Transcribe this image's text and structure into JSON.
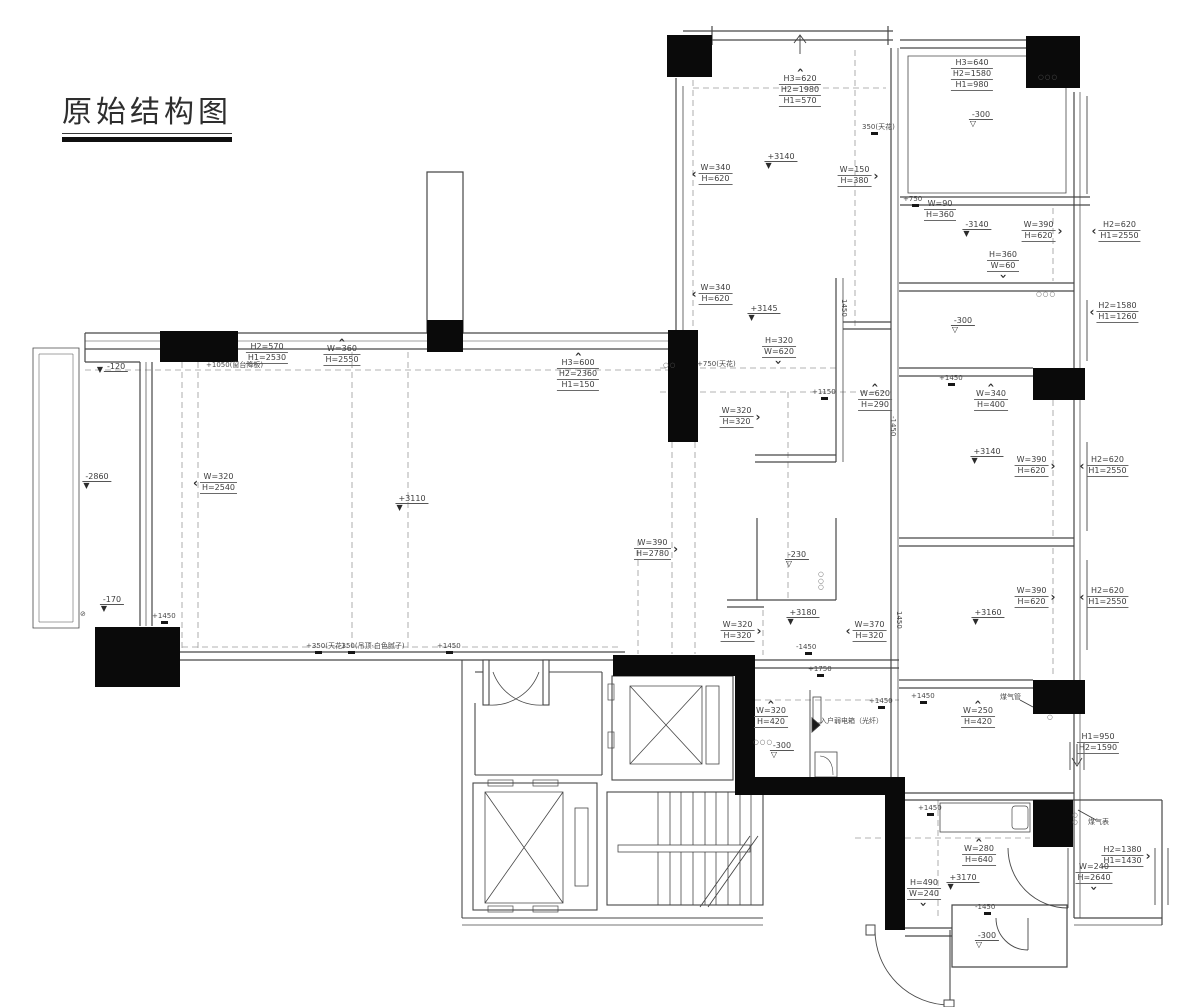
{
  "title": {
    "text": "原始结构图"
  },
  "colors": {
    "ink": "#3d3d3d",
    "wall": "#474747",
    "column": "#0a0a0a",
    "dashed": "#9a9a9a",
    "background": "#ffffff"
  },
  "annotations": [
    {
      "type": "dim",
      "x": 800,
      "y": 66,
      "lines": [
        "H3=620",
        "H2=1980",
        "H1=570"
      ],
      "arrow": "up"
    },
    {
      "type": "dim",
      "x": 712,
      "y": 163,
      "lines": [
        "W=340",
        "H=620"
      ],
      "arrow": "left"
    },
    {
      "type": "dim",
      "x": 858,
      "y": 165,
      "lines": [
        "W=150",
        "H=380"
      ],
      "arrow": "right"
    },
    {
      "type": "dim",
      "x": 972,
      "y": 58,
      "lines": [
        "H3=640",
        "H2=1580",
        "H1=980"
      ]
    },
    {
      "type": "dim",
      "x": 940,
      "y": 199,
      "lines": [
        "W=90",
        "H=360"
      ]
    },
    {
      "type": "dim",
      "x": 1042,
      "y": 220,
      "lines": [
        "W=390",
        "H=620"
      ],
      "arrow": "right"
    },
    {
      "type": "dim",
      "x": 1116,
      "y": 220,
      "lines": [
        "H2=620",
        "H1=2550"
      ],
      "arrow": "left"
    },
    {
      "type": "dim",
      "x": 1003,
      "y": 250,
      "lines": [
        "H=360",
        "W=60"
      ],
      "arrow": "down"
    },
    {
      "type": "dim",
      "x": 1114,
      "y": 301,
      "lines": [
        "H2=1580",
        "H1=1260"
      ],
      "arrow": "left"
    },
    {
      "type": "dim",
      "x": 712,
      "y": 283,
      "lines": [
        "W=340",
        "H=620"
      ],
      "arrow": "left"
    },
    {
      "type": "dim",
      "x": 779,
      "y": 336,
      "lines": [
        "H=320",
        "W=620"
      ],
      "arrow": "down"
    },
    {
      "type": "dim",
      "x": 875,
      "y": 381,
      "lines": [
        "W=620",
        "H=290"
      ],
      "arrow": "up"
    },
    {
      "type": "dim",
      "x": 740,
      "y": 406,
      "lines": [
        "W=320",
        "H=320"
      ],
      "arrow": "right"
    },
    {
      "type": "dim",
      "x": 267,
      "y": 342,
      "lines": [
        "H2=570",
        "H1=2530"
      ]
    },
    {
      "type": "dim",
      "x": 342,
      "y": 336,
      "lines": [
        "W=360",
        "H=2550"
      ],
      "arrow": "up"
    },
    {
      "type": "dim",
      "x": 578,
      "y": 350,
      "lines": [
        "H3=600",
        "H2=2360",
        "H1=150"
      ],
      "arrow": "up"
    },
    {
      "type": "dim",
      "x": 215,
      "y": 472,
      "lines": [
        "W=320",
        "H=2540"
      ],
      "arrow": "left"
    },
    {
      "type": "dim",
      "x": 656,
      "y": 538,
      "lines": [
        "W=390",
        "H=2780"
      ],
      "arrow": "right"
    },
    {
      "type": "dim",
      "x": 741,
      "y": 620,
      "lines": [
        "W=320",
        "H=320"
      ],
      "arrow": "right"
    },
    {
      "type": "dim",
      "x": 866,
      "y": 620,
      "lines": [
        "W=370",
        "H=320"
      ],
      "arrow": "left"
    },
    {
      "type": "dim",
      "x": 991,
      "y": 381,
      "lines": [
        "W=340",
        "H=400"
      ],
      "arrow": "up"
    },
    {
      "type": "dim",
      "x": 1035,
      "y": 455,
      "lines": [
        "W=390",
        "H=620"
      ],
      "arrow": "right"
    },
    {
      "type": "dim",
      "x": 1104,
      "y": 455,
      "lines": [
        "H2=620",
        "H1=2550"
      ],
      "arrow": "left"
    },
    {
      "type": "dim",
      "x": 1035,
      "y": 586,
      "lines": [
        "W=390",
        "H=620"
      ],
      "arrow": "right"
    },
    {
      "type": "dim",
      "x": 1104,
      "y": 586,
      "lines": [
        "H2=620",
        "H1=2550"
      ],
      "arrow": "left"
    },
    {
      "type": "dim",
      "x": 978,
      "y": 698,
      "lines": [
        "W=250",
        "H=420"
      ],
      "arrow": "up"
    },
    {
      "type": "dim",
      "x": 1098,
      "y": 732,
      "lines": [
        "H1=950",
        "H2=1590"
      ]
    },
    {
      "type": "dim",
      "x": 771,
      "y": 698,
      "lines": [
        "W=320",
        "H=420"
      ],
      "arrow": "up"
    },
    {
      "type": "dim",
      "x": 979,
      "y": 836,
      "lines": [
        "W=280",
        "H=640"
      ],
      "arrow": "up"
    },
    {
      "type": "dim",
      "x": 1126,
      "y": 845,
      "lines": [
        "H2=1380",
        "H1=1430"
      ],
      "arrow": "right"
    },
    {
      "type": "dim",
      "x": 1094,
      "y": 862,
      "lines": [
        "W=240",
        "H=2640"
      ],
      "arrow": "down"
    },
    {
      "type": "dim",
      "x": 924,
      "y": 878,
      "lines": [
        "H=490",
        "W=240"
      ],
      "arrow": "down"
    },
    {
      "type": "level",
      "x": 781,
      "y": 152,
      "text": "+3140",
      "tri": "filled"
    },
    {
      "type": "level",
      "x": 981,
      "y": 110,
      "text": "-300",
      "tri": "open"
    },
    {
      "type": "level",
      "x": 977,
      "y": 220,
      "text": "-3140",
      "tri": "filled"
    },
    {
      "type": "level",
      "x": 963,
      "y": 316,
      "text": "-300",
      "tri": "open"
    },
    {
      "type": "level",
      "x": 764,
      "y": 304,
      "text": "+3145",
      "tri": "filled"
    },
    {
      "type": "level",
      "x": 112,
      "y": 362,
      "text": "-120",
      "tri": "filled",
      "side": "left"
    },
    {
      "type": "level",
      "x": 97,
      "y": 472,
      "text": "-2860",
      "tri": "filled"
    },
    {
      "type": "level",
      "x": 412,
      "y": 494,
      "text": "+3110",
      "tri": "filled"
    },
    {
      "type": "level",
      "x": 112,
      "y": 595,
      "text": "-170",
      "tri": "filled"
    },
    {
      "type": "level",
      "x": 797,
      "y": 550,
      "text": "-230",
      "tri": "open"
    },
    {
      "type": "level",
      "x": 803,
      "y": 608,
      "text": "+3180",
      "tri": "filled"
    },
    {
      "type": "level",
      "x": 987,
      "y": 447,
      "text": "+3140",
      "tri": "filled"
    },
    {
      "type": "level",
      "x": 988,
      "y": 608,
      "text": "+3160",
      "tri": "filled"
    },
    {
      "type": "level",
      "x": 782,
      "y": 741,
      "text": "-300",
      "tri": "open"
    },
    {
      "type": "level",
      "x": 963,
      "y": 873,
      "text": "+3170",
      "tri": "filled"
    },
    {
      "type": "level",
      "x": 987,
      "y": 931,
      "text": "-300",
      "tri": "open"
    },
    {
      "type": "note",
      "x": 862,
      "y": 123,
      "text": "350(天花)",
      "tick": true
    },
    {
      "type": "note",
      "x": 903,
      "y": 195,
      "text": "+750",
      "tick": true
    },
    {
      "type": "note",
      "x": 848,
      "y": 299,
      "text": "1450",
      "rot": 90,
      "tick": false
    },
    {
      "type": "note",
      "x": 697,
      "y": 360,
      "text": "+750(天花)"
    },
    {
      "type": "note",
      "x": 206,
      "y": 361,
      "text": "+1050(窗台降板)"
    },
    {
      "type": "note",
      "x": 812,
      "y": 388,
      "text": "+1150",
      "tick": true
    },
    {
      "type": "note",
      "x": 939,
      "y": 374,
      "text": "+1450",
      "tick": true
    },
    {
      "type": "note",
      "x": 897,
      "y": 416,
      "text": "-1450",
      "rot": 90,
      "tick": false
    },
    {
      "type": "note",
      "x": 152,
      "y": 612,
      "text": "+1450",
      "tick": true
    },
    {
      "type": "note",
      "x": 306,
      "y": 642,
      "text": "+350(天花)",
      "tick": true
    },
    {
      "type": "note",
      "x": 339,
      "y": 642,
      "text": "-350(吊顶·白色腻子)",
      "tick": true
    },
    {
      "type": "note",
      "x": 437,
      "y": 642,
      "text": "+1450",
      "tick": true
    },
    {
      "type": "note",
      "x": 796,
      "y": 643,
      "text": "-1450",
      "tick": true
    },
    {
      "type": "note",
      "x": 808,
      "y": 665,
      "text": "+1750",
      "tick": true
    },
    {
      "type": "note",
      "x": 903,
      "y": 611,
      "text": "1450",
      "rot": 90,
      "tick": false
    },
    {
      "type": "note",
      "x": 911,
      "y": 692,
      "text": "+1450",
      "tick": true
    },
    {
      "type": "note",
      "x": 1000,
      "y": 693,
      "text": "煤气管"
    },
    {
      "type": "note",
      "x": 869,
      "y": 697,
      "text": "+1450",
      "tick": true
    },
    {
      "type": "note",
      "x": 820,
      "y": 717,
      "text": "入户弱电箱（光纤）"
    },
    {
      "type": "note",
      "x": 918,
      "y": 804,
      "text": "+1450",
      "tick": true
    },
    {
      "type": "note",
      "x": 1088,
      "y": 818,
      "text": "煤气表"
    },
    {
      "type": "note",
      "x": 975,
      "y": 903,
      "text": "-1450",
      "tick": true
    },
    {
      "type": "circles",
      "x": 1038,
      "y": 74,
      "count": 3,
      "dir": "h"
    },
    {
      "type": "circles",
      "x": 1036,
      "y": 291,
      "count": 3,
      "dir": "h"
    },
    {
      "type": "circles",
      "x": 818,
      "y": 571,
      "count": 3,
      "dir": "v"
    },
    {
      "type": "circles",
      "x": 663,
      "y": 362,
      "count": 2,
      "dir": "h"
    },
    {
      "type": "circles",
      "x": 753,
      "y": 739,
      "count": 3,
      "dir": "h"
    },
    {
      "type": "circles",
      "x": 1072,
      "y": 812,
      "count": 2,
      "dir": "v"
    },
    {
      "type": "circles",
      "x": 1047,
      "y": 714,
      "count": 1,
      "dir": "h"
    },
    {
      "type": "note",
      "x": 80,
      "y": 610,
      "text": "⊘"
    }
  ]
}
